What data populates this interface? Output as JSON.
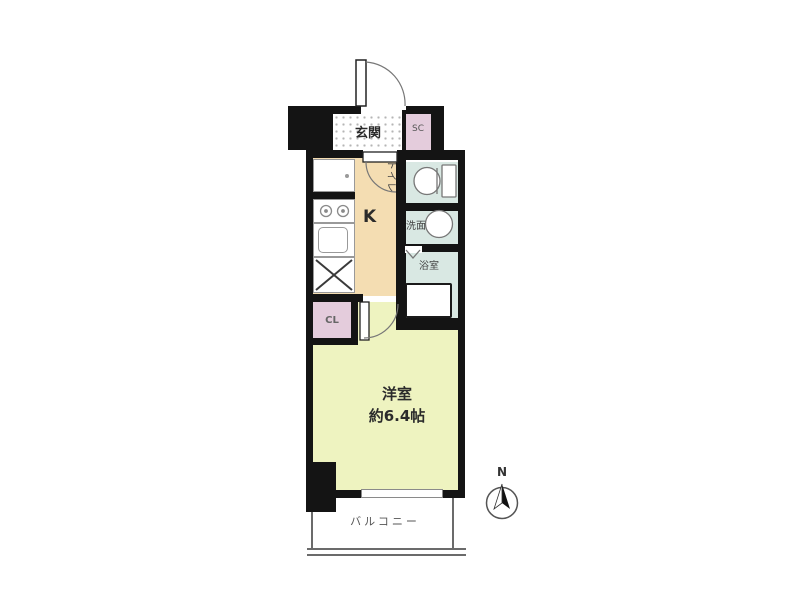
{
  "floorplan": {
    "rooms": {
      "entrance": {
        "label": "玄関"
      },
      "shoe_closet": {
        "label": "SC"
      },
      "toilet": {
        "label": "トイレ"
      },
      "washroom": {
        "label": "洗面"
      },
      "bathroom": {
        "label": "浴室"
      },
      "kitchen": {
        "label": "K"
      },
      "closet": {
        "label": "CL"
      },
      "western_room": {
        "label": "洋室",
        "area_label": "約6.4帖"
      },
      "balcony": {
        "label": "バルコニー"
      }
    },
    "compass": {
      "label": "N",
      "orientation": "north-up"
    },
    "colors": {
      "wall": "#141414",
      "kitchen_fill": "#f4ddb2",
      "wet_area_fill": "#d9e8e3",
      "closet_fill": "#e4ccdc",
      "western_room_fill": "#eef3c0",
      "entrance_tile": "#ffffff",
      "balcony_line": "#6b6b6b"
    }
  }
}
